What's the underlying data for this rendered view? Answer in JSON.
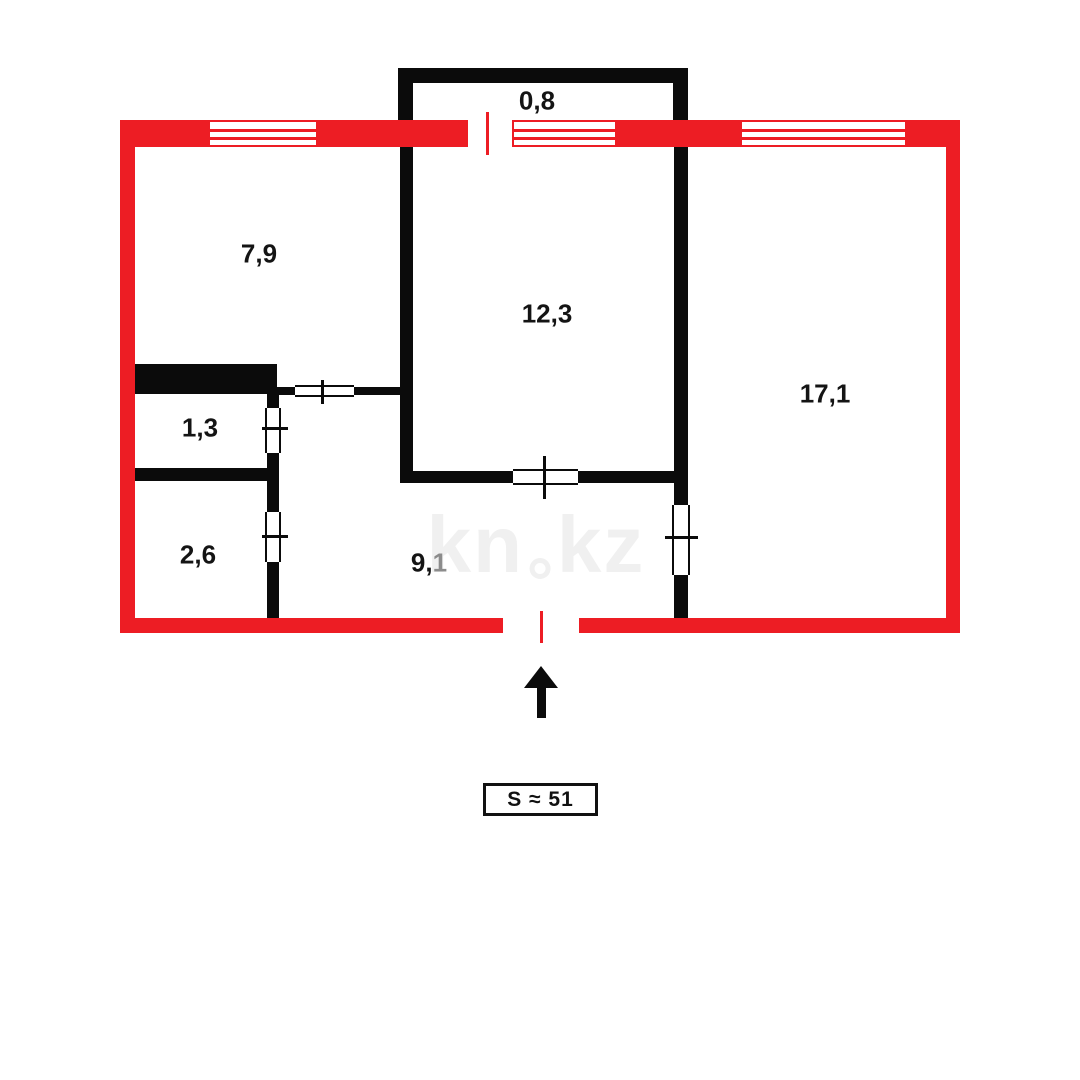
{
  "colors": {
    "outer_wall_red": "#ed1d24",
    "inner_wall_black": "#0b0b0b",
    "watermark_gray": "#f0f0f0",
    "hall_area_muted_gray": "#8c8c8c"
  },
  "plan": {
    "rooms": {
      "balcony": {
        "area": "0,8"
      },
      "top_left_room": {
        "area": "7,9"
      },
      "center_room": {
        "area": "12,3"
      },
      "right_room": {
        "area": "17,1"
      },
      "toilet": {
        "area": "1,3"
      },
      "bathroom": {
        "area": "2,6"
      },
      "hallway": {
        "area_prefix": "9,",
        "area_suffix": "1"
      }
    },
    "watermark": {
      "left": "kn",
      "right": "kz"
    }
  },
  "footer": {
    "total_area": "S ≈ 51"
  }
}
